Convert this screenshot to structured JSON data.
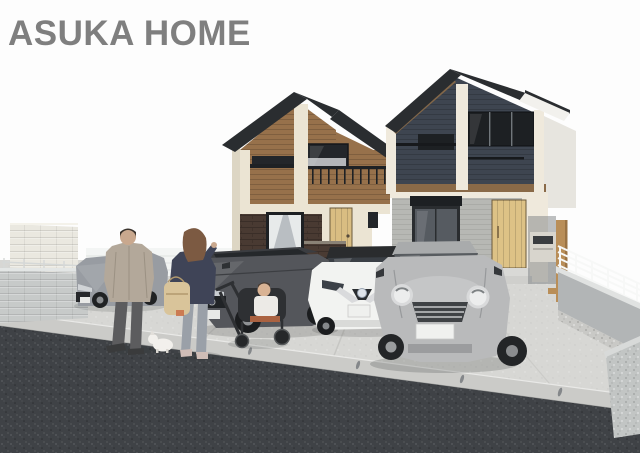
{
  "page": {
    "width": 640,
    "height": 453,
    "background_color": "#ffffff"
  },
  "header": {
    "logo_text": "ASUKA HOME",
    "logo_color": "#7f7f7f"
  },
  "scene": {
    "kind": "exterior rendering of two newly built two-story houses with shared parking area, four cars and a family",
    "sky_color": "#fdfdfd",
    "left_house": {
      "label": "left house (brown wood siding, dark brick first floor)",
      "roof_color": "#2a2d30",
      "siding_color": "#97714b",
      "trim_color": "#ebe4d3",
      "first_floor_color": "#493a32",
      "door_color": "#d9bd82"
    },
    "right_house": {
      "label": "right house (dark navy siding, light gray first floor)",
      "roof_color": "#2a2d30",
      "siding_color": "#3e4550",
      "trim_color": "#efe9dc",
      "first_floor_color": "#b7b8b4",
      "door_color": "#ddc286",
      "fascia_color": "#f2f1ed"
    },
    "ground": {
      "parking_color": "#d7d7d4",
      "gutter_color": "#cbcbc8",
      "asphalt_color": "#3f4246"
    },
    "walls_fences": {
      "tall_block_wall_color": "#eae8e0",
      "low_block_wall_color": "#c7cac9",
      "mesh_fence_color": "#f2f4f3",
      "retaining_wall_color": "#b2b5b6",
      "railing_color": "#f7f8f7",
      "gate_post_color": "#b98e58",
      "mailbox_color": "#d8d5cd"
    },
    "cars": [
      {
        "label": "gray hatchback behind family",
        "body_color": "#989ca2"
      },
      {
        "label": "dark gray hatchback",
        "body_color": "#54565b"
      },
      {
        "label": "white electric hatchback",
        "body_color": "#f2f3f1"
      },
      {
        "label": "silver compact car in foreground",
        "body_color": "#b9babb"
      }
    ],
    "people": [
      {
        "label": "man walking seen from behind",
        "jacket_color": "#b3a89a",
        "pants_color": "#5c5c5e"
      },
      {
        "label": "woman walking seen from behind",
        "top_color": "#3f4457",
        "pants_color": "#9aa0a8",
        "bag_color": "#d9c49a",
        "hair_color": "#7c5a42"
      },
      {
        "label": "toddler in stroller",
        "stroller_color": "#2e3033"
      },
      {
        "label": "small white dog",
        "color": "#f2f0ec"
      }
    ]
  }
}
